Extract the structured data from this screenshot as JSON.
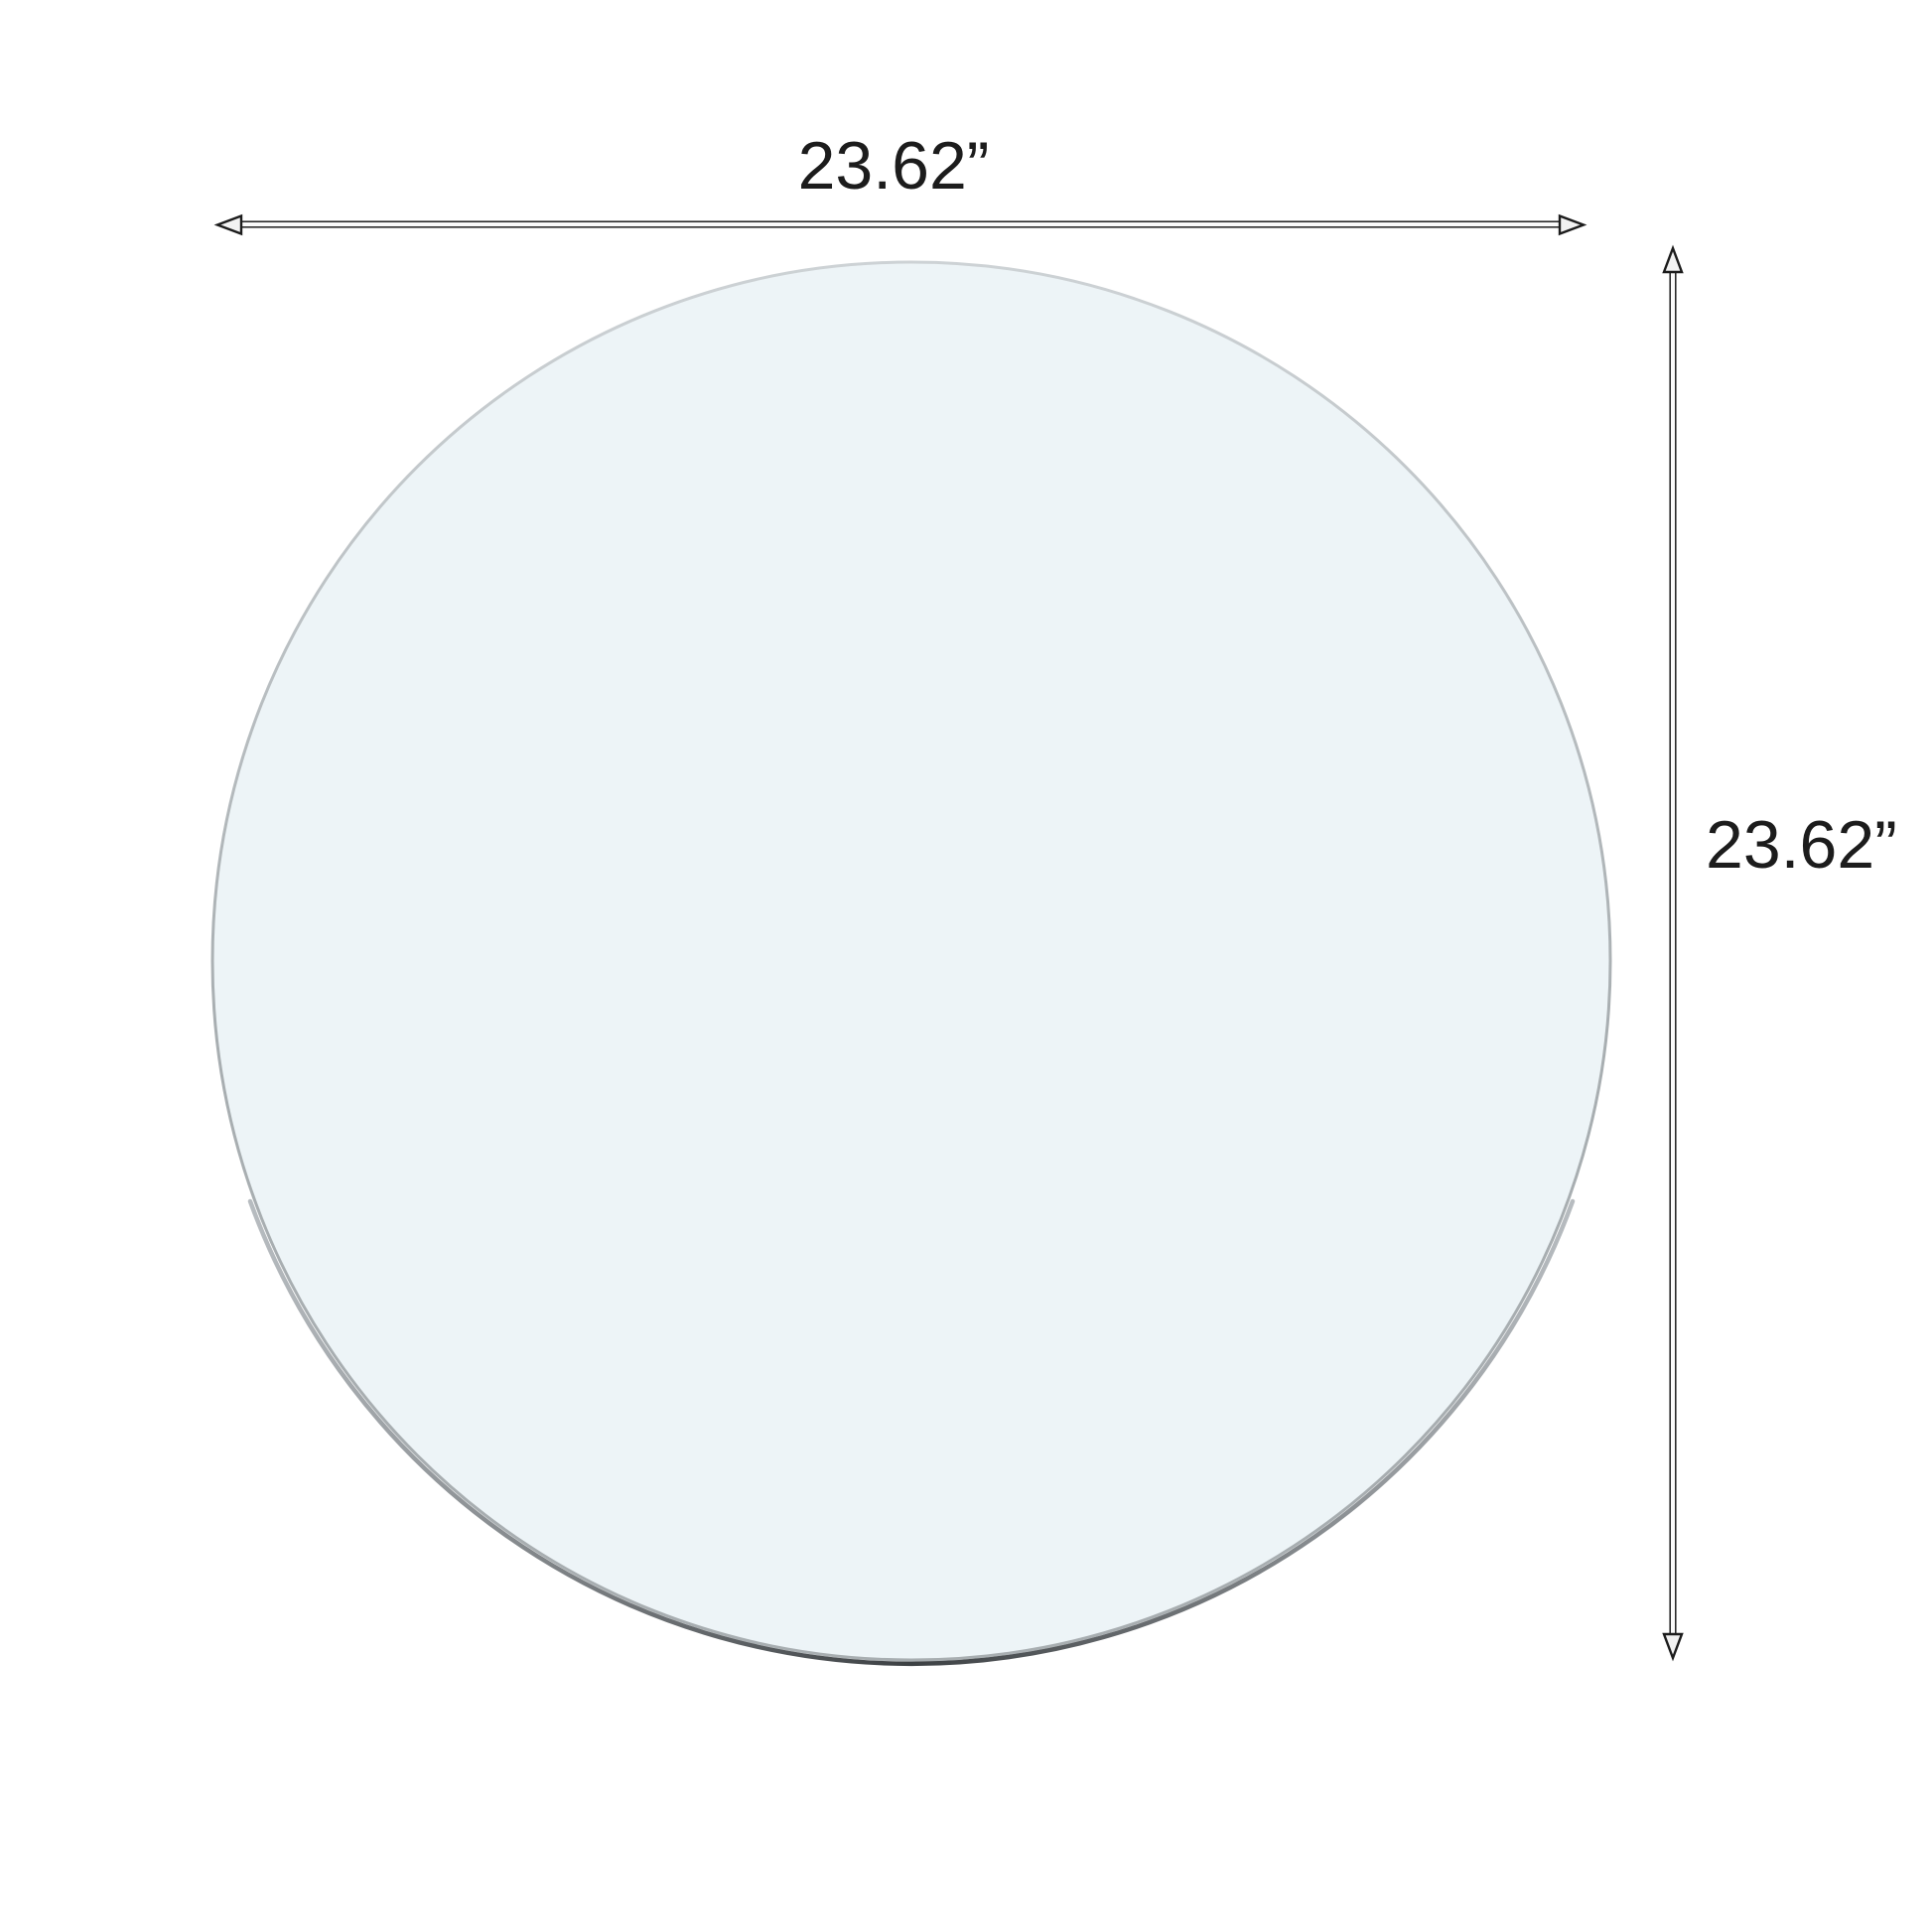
{
  "diagram": {
    "width_label": "23.62”",
    "height_label": "23.62”",
    "colors": {
      "background": "#ffffff",
      "glass_fill": "#edf4f7",
      "rim_light": "#cdd2d5",
      "rim_mid": "#a8aeb1",
      "rim_edge_light": "#b7bcc0",
      "rim_edge_dark": "#3c4043",
      "dimension_line": "#1c1c1c",
      "shaft_fill": "#fafafa",
      "arrowhead_fill": "#f2f2f2",
      "label_text": "#1c1c1c"
    }
  }
}
